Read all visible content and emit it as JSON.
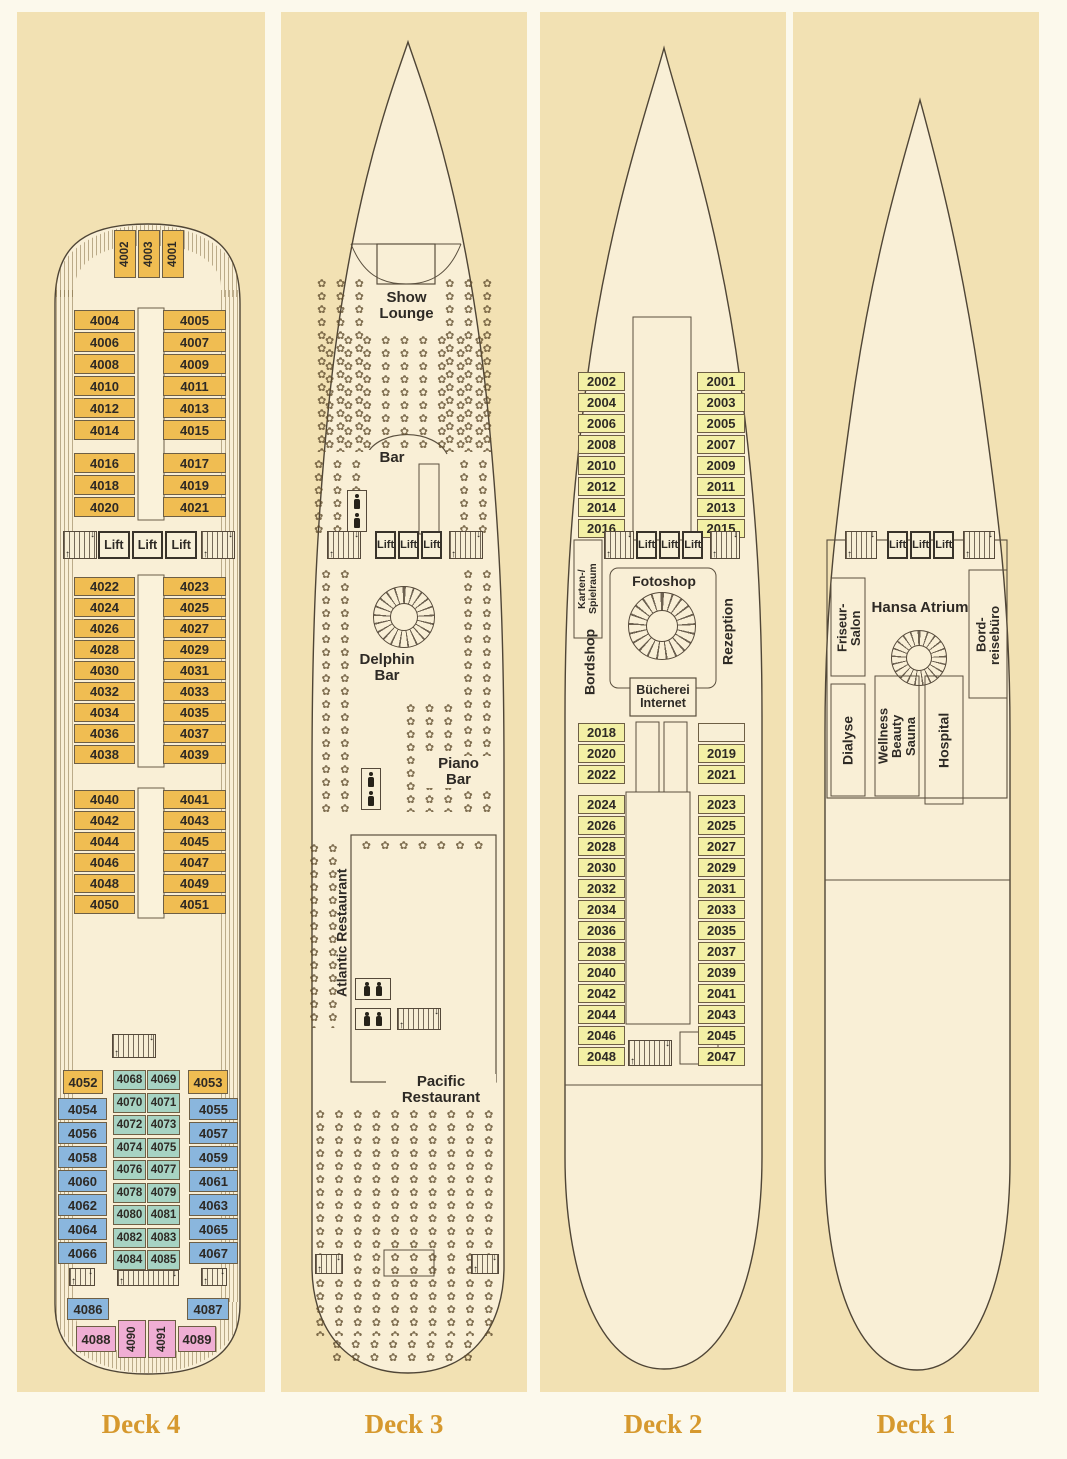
{
  "colors": {
    "page_bg": "#fcf9ec",
    "panel_bg": "#f2e1b3",
    "hull_fill": "#f9efd6",
    "hull_line": "#4f4536",
    "cabin_orange": "#f0bd52",
    "cabin_blue": "#8ab6dd",
    "cabin_teal": "#a7d3c3",
    "cabin_pink": "#f0aed4",
    "cabin_yellow": "#f3f0a5",
    "deck_label_color": "#d6992e"
  },
  "icons": {
    "table_glyph": "✿",
    "stairs_icon": "hatched-steps-with-arrows",
    "spiral_stairs_icon": "circular-spokes",
    "person_icon": "black-figure-silhouette",
    "lift_icon": "boxed-lift-label"
  },
  "decks": [
    {
      "label": "Deck 4",
      "lift_label": "Lift",
      "bow_cabins": [
        "4002",
        "4003",
        "4001"
      ],
      "sec1_left": [
        "4004",
        "4006",
        "4008",
        "4010",
        "4012",
        "4014"
      ],
      "sec1_right": [
        "4005",
        "4007",
        "4009",
        "4011",
        "4013",
        "4015"
      ],
      "sec2_left": [
        "4016",
        "4018",
        "4020"
      ],
      "sec2_right": [
        "4017",
        "4019",
        "4021"
      ],
      "sec3_left": [
        "4022",
        "4024",
        "4026",
        "4028",
        "4030",
        "4032",
        "4034",
        "4036",
        "4038"
      ],
      "sec3_right": [
        "4023",
        "4025",
        "4027",
        "4029",
        "4031",
        "4033",
        "4035",
        "4037",
        "4039"
      ],
      "sec4_left": [
        "4040",
        "4042",
        "4044",
        "4046",
        "4048",
        "4050"
      ],
      "sec4_right": [
        "4041",
        "4043",
        "4045",
        "4047",
        "4049",
        "4051"
      ],
      "aft_corner_left": "4052",
      "aft_corner_right": "4053",
      "aft_left": [
        "4054",
        "4056",
        "4058",
        "4060",
        "4062",
        "4064",
        "4066"
      ],
      "aft_right": [
        "4055",
        "4057",
        "4059",
        "4061",
        "4063",
        "4065",
        "4067"
      ],
      "aft_center_left": [
        "4068",
        "4070",
        "4072",
        "4074",
        "4076",
        "4078",
        "4080",
        "4082",
        "4084"
      ],
      "aft_center_right": [
        "4069",
        "4071",
        "4073",
        "4075",
        "4077",
        "4079",
        "4081",
        "4083",
        "4085"
      ],
      "stern_left": "4086",
      "stern_right": "4087",
      "stern_pink_left": "4088",
      "stern_pink_rot": [
        "4090",
        "4091"
      ],
      "stern_pink_right": "4089"
    },
    {
      "label": "Deck 3",
      "lift_label": "Lift",
      "venues": {
        "show_lounge": "Show\nLounge",
        "bar": "Bar",
        "delphin_bar": "Delphin\nBar",
        "piano_bar": "Piano\nBar",
        "atlantic": "Atlantic Restaurant",
        "pacific": "Pacific\nRestaurant"
      }
    },
    {
      "label": "Deck 2",
      "lift_label": "Lift",
      "sec1_left": [
        "2002",
        "2004",
        "2006",
        "2008",
        "2010",
        "2012",
        "2014",
        "2016"
      ],
      "sec1_right": [
        "2001",
        "2003",
        "2005",
        "2007",
        "2009",
        "2011",
        "2013",
        "2015"
      ],
      "sec2_left": [
        "2018",
        "2020",
        "2022"
      ],
      "sec2_right": [
        "",
        "2019",
        "2021"
      ],
      "sec3_left": [
        "2024",
        "2026",
        "2028",
        "2030",
        "2032",
        "2034",
        "2036",
        "2038",
        "2040",
        "2042",
        "2044",
        "2046",
        "2048"
      ],
      "sec3_right": [
        "2023",
        "2025",
        "2027",
        "2029",
        "2031",
        "2033",
        "2035",
        "2037",
        "2039",
        "2041",
        "2043",
        "2045",
        "2047"
      ],
      "rooms": {
        "karten": "Karten-/\nSpielraum",
        "fotoshop": "Fotoshop",
        "bordshop": "Bordshop",
        "rezeption": "Rezeption",
        "buecherei": "Bücherei\nInternet"
      }
    },
    {
      "label": "Deck 1",
      "lift_label": "Lift",
      "rooms": {
        "friseur": "Friseur-\nSalon",
        "atrium": "Hansa Atrium",
        "bordreisebuero": "Bord-\nreisebüro",
        "dialyse": "Dialyse",
        "wellness": "Wellness\nBeauty\nSauna",
        "hospital": "Hospital"
      }
    }
  ]
}
